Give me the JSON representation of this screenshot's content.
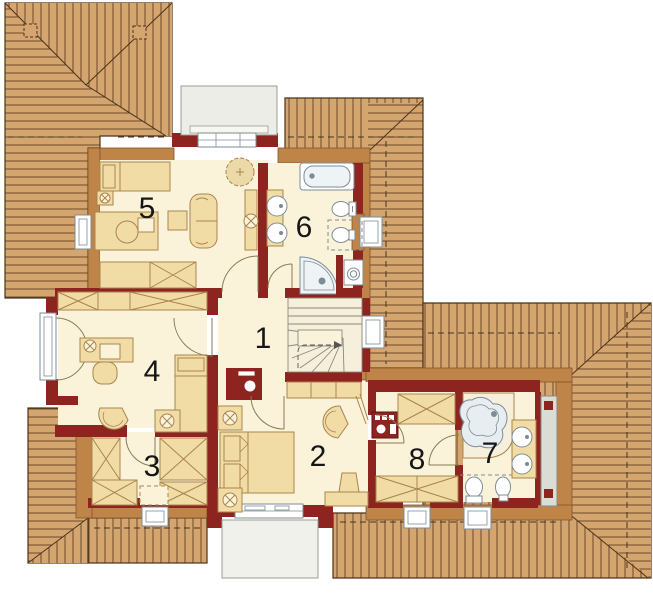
{
  "plan": {
    "type": "floor-plan",
    "rooms": [
      {
        "number": "1"
      },
      {
        "number": "2"
      },
      {
        "number": "3"
      },
      {
        "number": "4"
      },
      {
        "number": "5"
      },
      {
        "number": "6"
      },
      {
        "number": "7"
      },
      {
        "number": "8"
      }
    ],
    "fixtures": [
      "stairs",
      "chimney",
      "bathtub",
      "shower",
      "toilet",
      "bidet",
      "washbasin",
      "washing-machine",
      "corner-bath",
      "bed",
      "double-bed",
      "desk",
      "office-chair",
      "armchair",
      "sofa",
      "wardrobe",
      "sideboard",
      "plant",
      "lamp",
      "kitchenette",
      "balcony",
      "roof-window",
      "dormer",
      "window"
    ],
    "colors": {
      "roof": "#d5a570",
      "roof_line": "#6b4a28",
      "roof_outline": "#4a3318",
      "knee_wall": "#bf8548",
      "wall": "#8e2420",
      "floor": "#faf3da",
      "furniture": "#f2dca6",
      "furniture_line": "#a9844d",
      "fixture_fill": "#e7edf0",
      "fixture_line": "#7d8c96",
      "dormer": "#ededе8",
      "gray_structure": "#dcdcd6"
    }
  }
}
